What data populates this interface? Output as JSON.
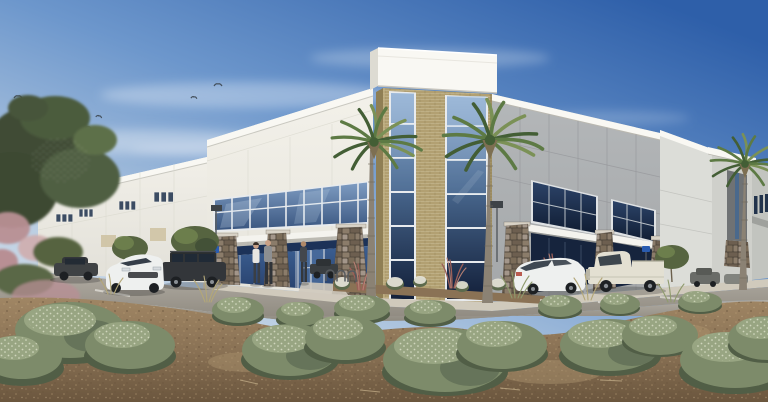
{
  "scene": {
    "title": "Architectural rendering of a white tilt-up industrial / warehouse building with a tan brick and blue glass entry tower, fan palms, parked cars and desert landscaping under a blue sky",
    "objects": [
      "sky",
      "clouds",
      "bird-flock",
      "large-tree",
      "pink-flowering-shrub",
      "west-wing-wall",
      "clerestory-windows",
      "entry-facade",
      "upper-window-band",
      "entry-canopy",
      "storefront-glazing",
      "entry-doors",
      "stone-pillars",
      "glass-tower",
      "tower-parapet-cap",
      "tower-glass-curtainwall",
      "gray-panel-facade",
      "window-bay-1",
      "window-bay-2",
      "right-wing",
      "accent-column",
      "sidewalk",
      "planting-bed",
      "parking-lot",
      "white-sedan-front",
      "dark-suv",
      "dark-car",
      "white-sedan-rear",
      "white-pickup-truck",
      "distant-cars",
      "pedestrians",
      "bike-racks",
      "parking-signs",
      "light-pole",
      "palm-tree-left",
      "palm-tree-right",
      "palm-tree-far-right",
      "mulch-ground",
      "sage-shrubs",
      "ornamental-grasses",
      "red-plume-grasses",
      "white-flower-shrubs"
    ],
    "people_count": 3,
    "palm_count": 3,
    "vehicle_count": 8
  },
  "colors": {
    "sky-top": "#2e5fa9",
    "sky-mid": "#6d97cc",
    "sky-low": "#b9cde2",
    "sky-horizon": "#dde6ee",
    "cloud": "#eef3f8",
    "bird": "#44505c",
    "wall-white": "#f1efe8",
    "wall-white-shade": "#e2e0d8",
    "parapet": "#f9f8f3",
    "wall-under": "#c9c8c0",
    "panel-gray": "#b4b7b9",
    "panel-gray-dark": "#a4a7a9",
    "seam": "#97999c",
    "brick": "#b2a072",
    "brick-light": "#c4b488",
    "brick-dark": "#8f7f55",
    "mortar": "#c3b58c",
    "glass-light": "#8fadd1",
    "glass-mid": "#49688f",
    "glass-dark": "#1d3050",
    "glass-deep": "#13203a",
    "mullion": "#e8ebee",
    "storefront-band": "#1c3258",
    "storefront-glass": "#3c5f92",
    "storefront-glass-dark": "#27406b",
    "stone-grout": "#564c40",
    "stone-1": "#8b7c6a",
    "stone-2": "#6d5f50",
    "stone-3": "#a3968a",
    "stone-4": "#7b6c59",
    "canopy": "#f4f3ee",
    "sidewalk": "#d0cabc",
    "asphalt-far": "#b2ada4",
    "asphalt-near": "#8d887e",
    "stripe": "#e8e6df",
    "mulch-light": "#a08664",
    "mulch": "#8a7255",
    "mulch-dark": "#6b563e",
    "debris": "#c9b48e",
    "shrub-dark": "#515e46",
    "shrub-mid": "#7d8b6a",
    "shrub-light": "#98a582",
    "shrub-speckle": "#d9dfc6",
    "grass-tan": "#b3a778",
    "grass-green": "#8f9b6d",
    "tree-dark": "#3f4c35",
    "tree-mid": "#566440",
    "tree-light": "#6f814e",
    "pink-bloom": "#b88f94",
    "pink-bloom-light": "#cfadae",
    "red-plume": "#9b5f58",
    "red-plume-light": "#b57f72",
    "palm-frond": "#5d7a44",
    "palm-frond-dark": "#435e35",
    "palm-frond-light": "#7b9156",
    "palm-trunk": "#8b8274",
    "palm-trunk-dark": "#6e6759",
    "palm-skirt": "#7d6f52",
    "car-white": "#eef0ef",
    "car-dark": "#33363a",
    "car-glass": "#202a36",
    "tire": "#1d2023",
    "truck-white": "#e3e0d2",
    "sign-blue": "#2a5cb0",
    "pole": "#5a5f63",
    "skin": "#c9a186",
    "person-dark": "#3a3f45",
    "person-light-top": "#e8e6e1"
  }
}
